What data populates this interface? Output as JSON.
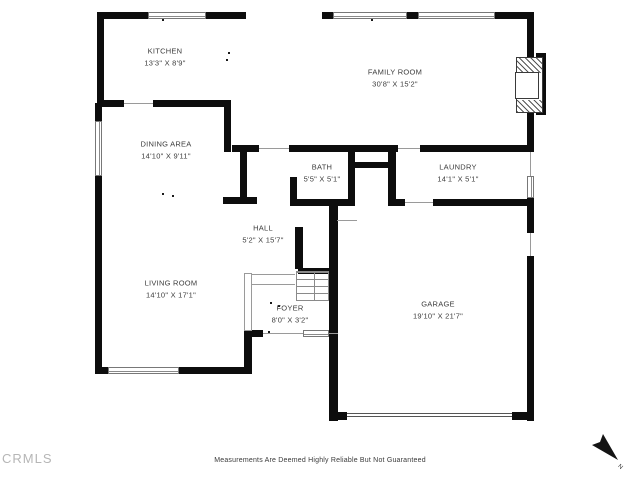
{
  "rooms": [
    {
      "name": "KITCHEN",
      "dims": "13'3\" X 8'9\""
    },
    {
      "name": "FAMILY ROOM",
      "dims": "30'8\" X 15'2\""
    },
    {
      "name": "DINING AREA",
      "dims": "14'10\" X 9'11\""
    },
    {
      "name": "BATH",
      "dims": "5'5\" X 5'1\""
    },
    {
      "name": "LAUNDRY",
      "dims": "14'1\" X 5'1\""
    },
    {
      "name": "HALL",
      "dims": "5'2\" X 15'7\""
    },
    {
      "name": "LIVING ROOM",
      "dims": "14'10\" X 17'1\""
    },
    {
      "name": "FOYER",
      "dims": "8'0\" X 3'2\""
    },
    {
      "name": "GARAGE",
      "dims": "19'10\" X 21'7\""
    }
  ],
  "footer": {
    "watermark": "CRMLS",
    "disclaimer": "Measurements Are Deemed Highly Reliable But Not Guaranteed"
  },
  "compass": {
    "label": "N"
  },
  "colors": {
    "wall": "#0d0d0d",
    "thin_line": "#9a9a9a",
    "label_text": "#3c3c3c",
    "watermark": "#b6b6b6"
  }
}
